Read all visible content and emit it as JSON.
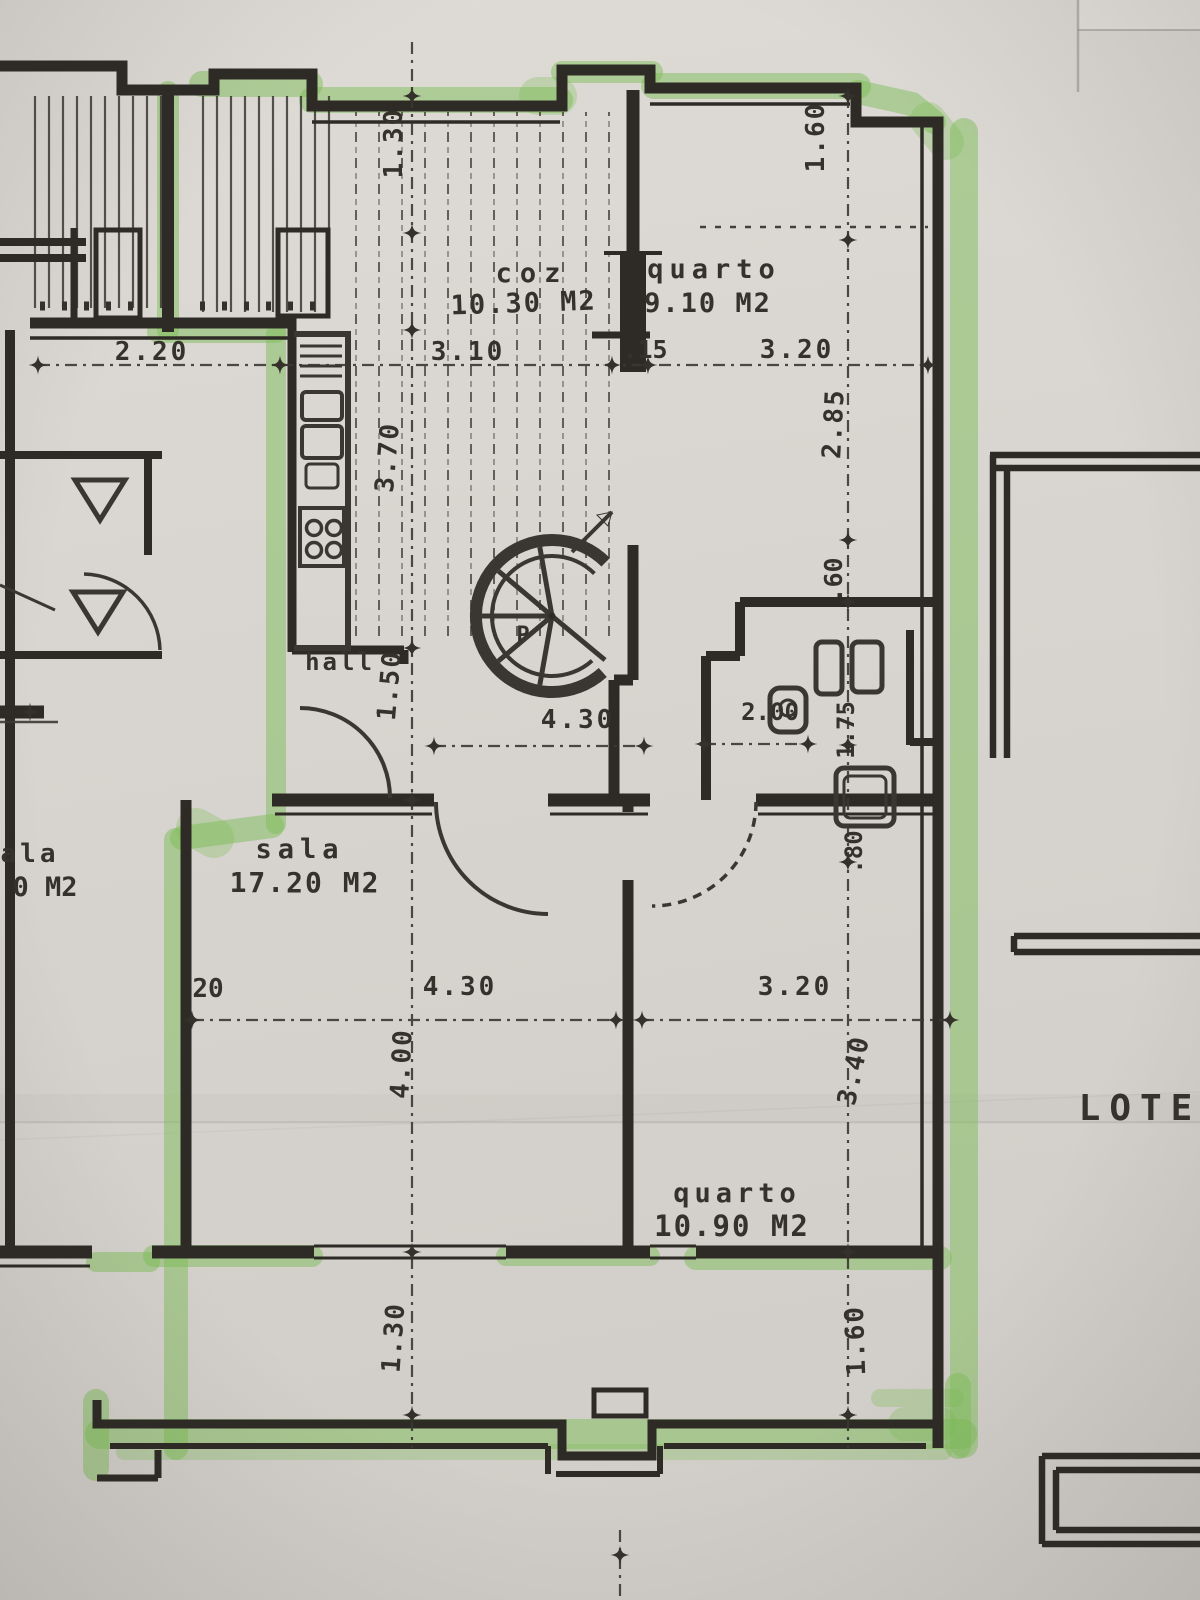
{
  "rooms": {
    "kitchen": {
      "label": "coz",
      "area": "10.30 M2"
    },
    "bedroom_top": {
      "label": "quarto",
      "area": "9.10 M2"
    },
    "living_room": {
      "label": "sala",
      "area": "17.20 M2"
    },
    "bedroom_bottom": {
      "label": "quarto",
      "area": "10.90 M2"
    },
    "hall": {
      "label": "hall"
    },
    "stair": {
      "label": "P"
    },
    "adjacent_room_partial": {
      "label": "ala",
      "area": "0 M2"
    },
    "lot": {
      "label": "LOTE"
    }
  },
  "dimensions": {
    "top_130": "1.30",
    "top_160": "1.60",
    "left_220": "2.20",
    "kitchen_310": "3.10",
    "wall_15": ".15",
    "bedtop_320": "3.20",
    "bedtop_285": "2.85",
    "kitchen_370": "3.70",
    "step_60": ".60",
    "hall_150": "1.50",
    "mid_430": "4.30",
    "bath_200": "2.00",
    "bath_175": "1.75",
    "bath_80": ".80",
    "wall_20": "20",
    "sala_430": "4.30",
    "sala_400": "4.00",
    "bedbot_320": "3.20",
    "bedbot_340": "3.40",
    "bottom_130": "1.30",
    "bottom_160": "1.60"
  },
  "colors": {
    "highlighter_green": "#7dbd58",
    "ink": "#2e2b26",
    "paper": "#d8d4cf"
  }
}
